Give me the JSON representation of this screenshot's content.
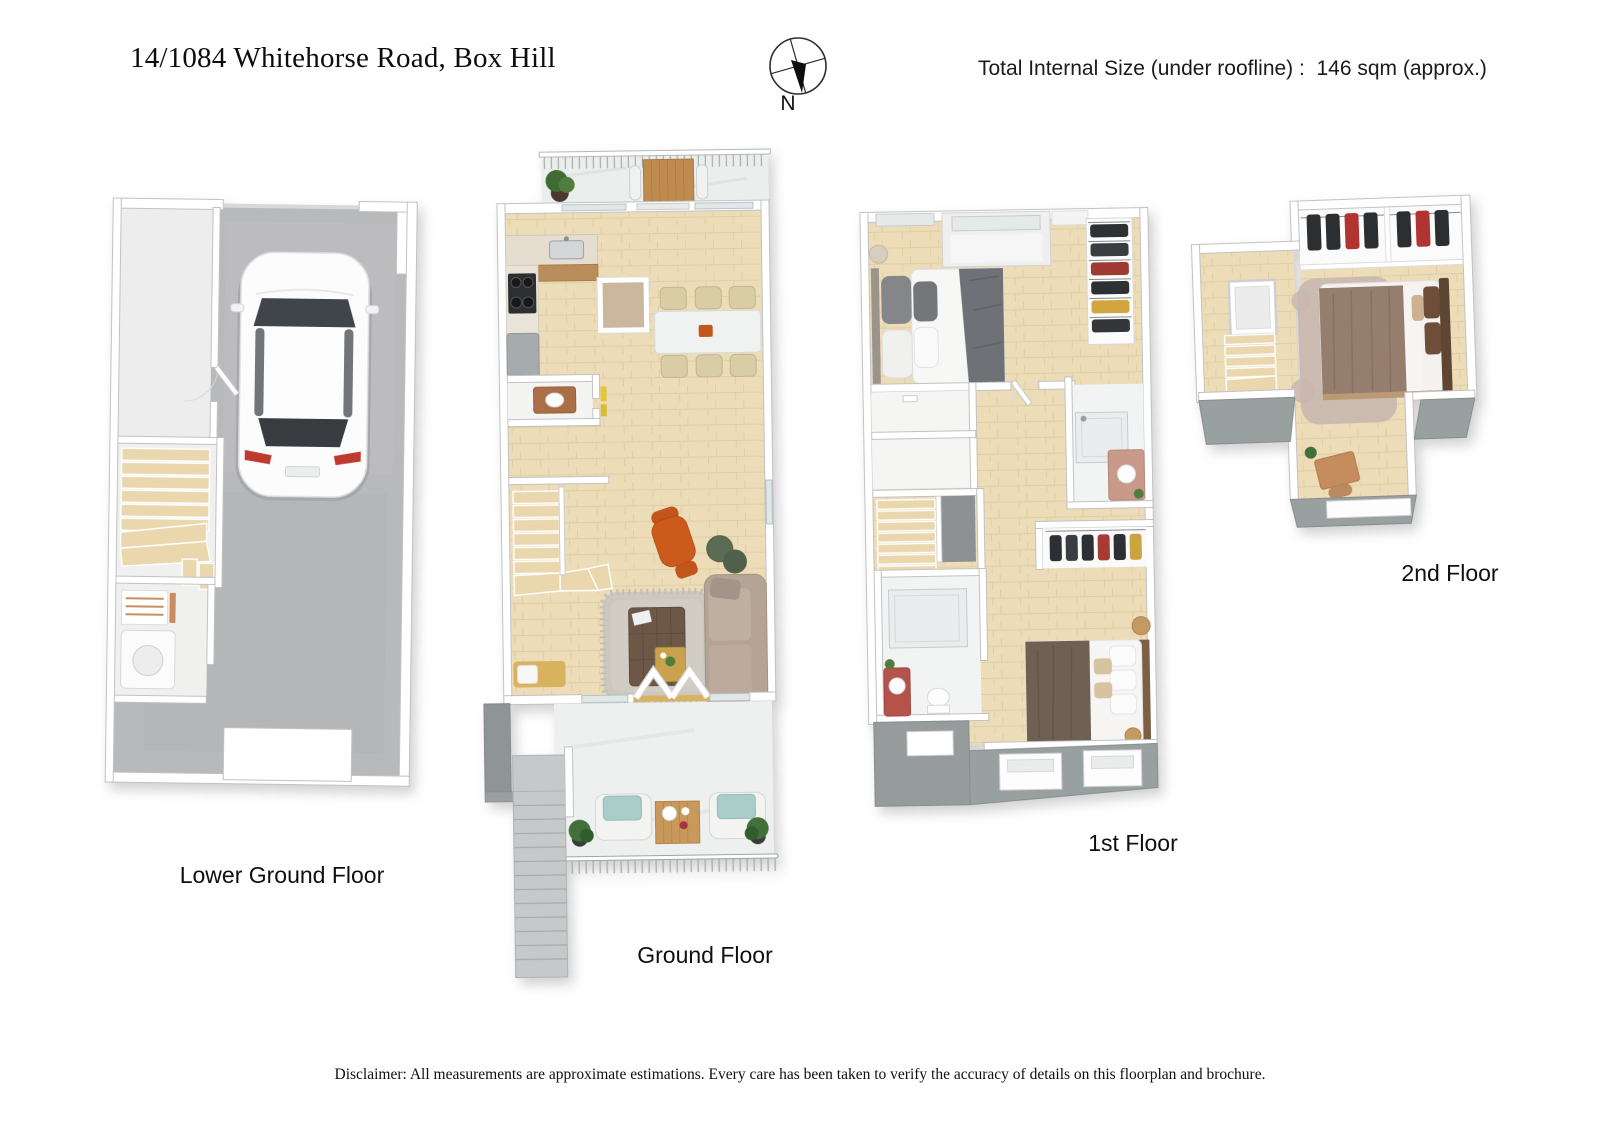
{
  "header": {
    "title": "14/1084 Whitehorse Road, Box Hill",
    "size_note": "Total Internal Size (under roofline) :  146 sqm (approx.)",
    "compass_n": "N"
  },
  "floors": [
    {
      "id": "lower-ground",
      "label": "Lower Ground Floor"
    },
    {
      "id": "ground",
      "label": "Ground Floor"
    },
    {
      "id": "first",
      "label": "1st Floor"
    },
    {
      "id": "second",
      "label": "2nd Floor"
    }
  ],
  "footer": {
    "disclaimer": "Disclaimer: All measurements are approximate estimations. Every care has been taken to verify the accuracy of details on this floorplan and brochure."
  },
  "colors": {
    "wall": "#ffffff",
    "wall_edge": "#c2c2c2",
    "wood_floor": "#ecdcb8",
    "garage_concrete": "#b8b9bb",
    "terrace_stone": "#edf0ef",
    "roof_slab_grey": "#99a0a0",
    "stair_tread": "#ead7ad",
    "accent_orange_chair": "#cd5a1d",
    "teal_cushion": "#a9cdc9",
    "sofa_taupe": "#b5a495",
    "bed_grey_throw": "#6e7175",
    "bed_brown_blanket": "#6e6153",
    "bed_mauve_duvet": "#967e6f"
  }
}
